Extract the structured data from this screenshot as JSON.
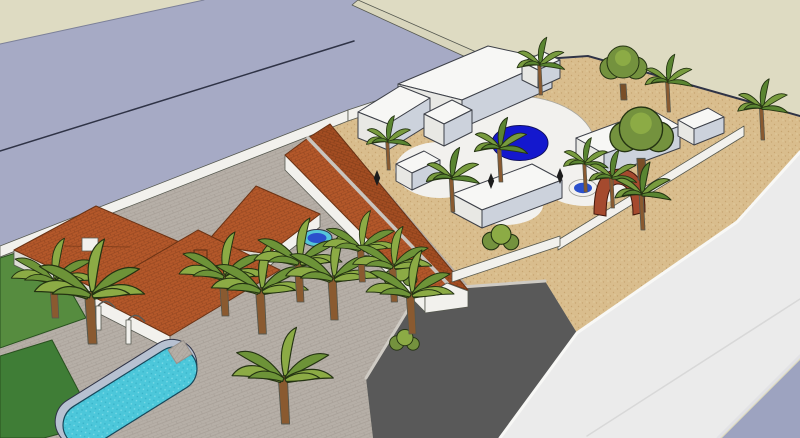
{
  "app": {
    "name": "3d-model-viewport",
    "view_label": "aerial 3d massing model of two villa properties"
  },
  "palette": {
    "backdrop": "#dedbc2",
    "road_main": "#a6aac5",
    "road_corner": "#9da3c0",
    "road_side": "#ebebeb",
    "road_seam": "#d8d8d8",
    "curb_khaki": "#d9d6bd",
    "curb_light": "#cfcbc4",
    "driveway": "#595959",
    "sand": "#d9bd8d",
    "sand_dot": "#c7a671",
    "sand_dot_light": "#e6d2a5",
    "paving": "#b6afa7",
    "paving_line": "#a79f97",
    "grass": "#3f7d36",
    "grass_light": "#568c3f",
    "roof": "#b4582a",
    "roof_line": "#8f431f",
    "roof_dark": "#a34d22",
    "roof_dark_line": "#7d3a18",
    "ridge": "#c9c5bf",
    "wall_white": "#f2f1ed",
    "wall_shade": "#dddcd6",
    "terrace": "#f2f1ee",
    "prism_top": "#f7f7f5",
    "prism_left": "#e8e8e4",
    "prism_right": "#ccd2dc",
    "pool_long_water": "#4cc7da",
    "pool_long_dot": "#7fdde9",
    "pool_long_dot_dark": "#37b2c8",
    "pool_coping": "#b7c1d1",
    "pool_round": "#1418ce",
    "spa_blue": "#2b50cc",
    "spa_cyan": "#56c6d8",
    "spa_ring": "#f2f1ee",
    "arch": "#a54a2e",
    "boundary": "#2f3346",
    "palm_frond": "#789b3e",
    "palm_frond_dark": "#5a8531",
    "palm_trunk": "#8a5a30",
    "banana_frond": "#8cab45",
    "banana_frond_dark": "#6d9338",
    "tree_canopy": "#74923e",
    "tree_canopy_light": "#8cab45",
    "tree_trunk": "#7a4f28",
    "figure": "#1c1c1c"
  },
  "scene": {
    "counts": {
      "palm_trees": 19,
      "round_trees": 2,
      "shrubs": 3,
      "pools": 4,
      "figures": 3
    },
    "areas": [
      "main-road",
      "side-road",
      "driveway",
      "sand-yard",
      "paved-courtyard",
      "grass-strips",
      "unbuilt-ground"
    ],
    "structures": [
      "tiled-roof-house",
      "tiled-roof-pavilion",
      "long-tiled-roof-building",
      "white-villa-blocks",
      "perimeter-wall",
      "red-arch",
      "veranda-arches"
    ]
  }
}
